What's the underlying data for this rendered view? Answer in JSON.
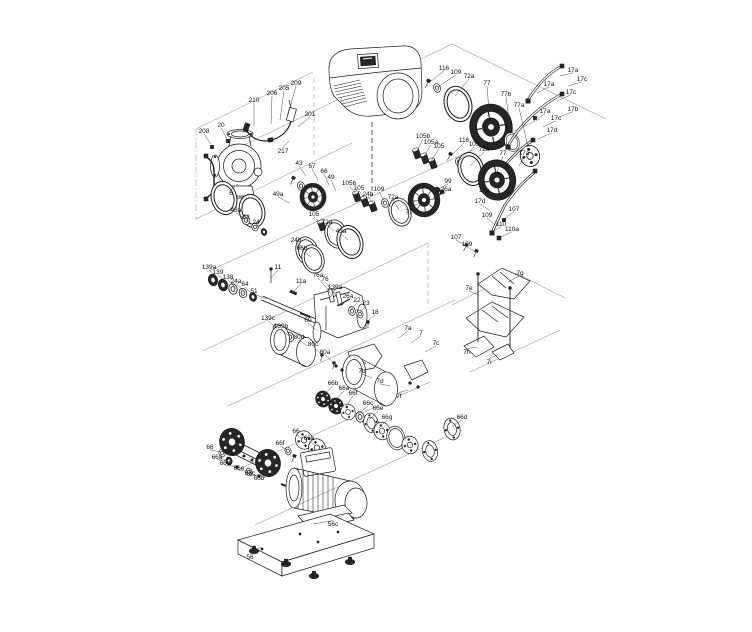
{
  "diagram": {
    "type": "exploded-parts-diagram",
    "colors": {
      "ink": "#1c1c1c",
      "lane": "#949494",
      "dark_fill": "#262626",
      "paper": "#ffffff"
    },
    "callouts": [
      {
        "t": "208",
        "x": 204,
        "y": 131,
        "tx": 211,
        "ty": 144
      },
      {
        "t": "20",
        "x": 221,
        "y": 125,
        "tx": 227,
        "ty": 139
      },
      {
        "t": "210",
        "x": 254,
        "y": 100,
        "tx": 254,
        "ty": 126
      },
      {
        "t": "206",
        "x": 272,
        "y": 93,
        "tx": 271,
        "ty": 124
      },
      {
        "t": "205",
        "x": 284,
        "y": 88,
        "tx": 280,
        "ty": 120
      },
      {
        "t": "209",
        "x": 296,
        "y": 83,
        "tx": 288,
        "ty": 115
      },
      {
        "t": "201",
        "x": 310,
        "y": 114,
        "tx": 298,
        "ty": 127
      },
      {
        "t": "217",
        "x": 283,
        "y": 151,
        "tx": 289,
        "ty": 141
      },
      {
        "t": "6",
        "x": 231,
        "y": 193,
        "tx": 238,
        "ty": 184
      },
      {
        "t": "116",
        "x": 444,
        "y": 68,
        "tx": 430,
        "ty": 82
      },
      {
        "t": "109",
        "x": 456,
        "y": 72,
        "tx": 438,
        "ty": 87
      },
      {
        "t": "72a",
        "x": 469,
        "y": 76,
        "tx": 455,
        "ty": 96
      },
      {
        "t": "77",
        "x": 487,
        "y": 83,
        "tx": 489,
        "ty": 112
      },
      {
        "t": "77b",
        "x": 506,
        "y": 94,
        "tx": 511,
        "ty": 135
      },
      {
        "t": "77a",
        "x": 519,
        "y": 105,
        "tx": 528,
        "ty": 147
      },
      {
        "t": "17a",
        "x": 573,
        "y": 70,
        "tx": 560,
        "ty": 76
      },
      {
        "t": "17c",
        "x": 582,
        "y": 79,
        "tx": 568,
        "ty": 86
      },
      {
        "t": "17a",
        "x": 549,
        "y": 84,
        "tx": 537,
        "ty": 93
      },
      {
        "t": "17c",
        "x": 571,
        "y": 92,
        "tx": 557,
        "ty": 101
      },
      {
        "t": "17b",
        "x": 573,
        "y": 109,
        "tx": 559,
        "ty": 117
      },
      {
        "t": "17a",
        "x": 545,
        "y": 111,
        "tx": 533,
        "ty": 121
      },
      {
        "t": "17c",
        "x": 556,
        "y": 118,
        "tx": 543,
        "ty": 127
      },
      {
        "t": "17d",
        "x": 552,
        "y": 130,
        "tx": 538,
        "ty": 139
      },
      {
        "t": "105b",
        "x": 423,
        "y": 136,
        "tx": 417,
        "ty": 151
      },
      {
        "t": "105a",
        "x": 431,
        "y": 142,
        "tx": 424,
        "ty": 156
      },
      {
        "t": "105",
        "x": 439,
        "y": 146,
        "tx": 431,
        "ty": 161
      },
      {
        "t": "116",
        "x": 464,
        "y": 140,
        "tx": 451,
        "ty": 156
      },
      {
        "t": "109",
        "x": 474,
        "y": 144,
        "tx": 459,
        "ty": 161
      },
      {
        "t": "72a",
        "x": 484,
        "y": 149,
        "tx": 470,
        "ty": 166
      },
      {
        "t": "77",
        "x": 503,
        "y": 153,
        "tx": 497,
        "ty": 172
      },
      {
        "t": "17a",
        "x": 524,
        "y": 153,
        "tx": 519,
        "ty": 166
      },
      {
        "t": "17c",
        "x": 484,
        "y": 190,
        "tx": 493,
        "ty": 199
      },
      {
        "t": "17d",
        "x": 480,
        "y": 201,
        "tx": 489,
        "ty": 210
      },
      {
        "t": "107",
        "x": 514,
        "y": 209,
        "tx": 504,
        "ty": 219
      },
      {
        "t": "109",
        "x": 487,
        "y": 215,
        "tx": 495,
        "ty": 225
      },
      {
        "t": "110",
        "x": 501,
        "y": 224,
        "tx": 491,
        "ty": 232
      },
      {
        "t": "110a",
        "x": 512,
        "y": 229,
        "tx": 499,
        "ty": 238
      },
      {
        "t": "107",
        "x": 456,
        "y": 237,
        "tx": 466,
        "ty": 246
      },
      {
        "t": "109",
        "x": 467,
        "y": 244,
        "tx": 476,
        "ty": 252
      },
      {
        "t": "105b",
        "x": 349,
        "y": 183,
        "tx": 357,
        "ty": 195
      },
      {
        "t": "105",
        "x": 359,
        "y": 188,
        "tx": 366,
        "ty": 200
      },
      {
        "t": "24b",
        "x": 368,
        "y": 194,
        "tx": 375,
        "ty": 206
      },
      {
        "t": "109",
        "x": 379,
        "y": 189,
        "tx": 385,
        "ty": 202
      },
      {
        "t": "72a",
        "x": 393,
        "y": 197,
        "tx": 399,
        "ty": 210
      },
      {
        "t": "99",
        "x": 448,
        "y": 181,
        "tx": 437,
        "ty": 190
      },
      {
        "t": "26a",
        "x": 446,
        "y": 189,
        "tx": 433,
        "ty": 198
      },
      {
        "t": "77",
        "x": 409,
        "y": 212,
        "tx": 417,
        "ty": 204
      },
      {
        "t": "43",
        "x": 299,
        "y": 163,
        "tx": 306,
        "ty": 176
      },
      {
        "t": "67",
        "x": 312,
        "y": 166,
        "tx": 318,
        "ty": 180
      },
      {
        "t": "66",
        "x": 324,
        "y": 171,
        "tx": 329,
        "ty": 185
      },
      {
        "t": "49",
        "x": 331,
        "y": 177,
        "tx": 336,
        "ty": 191
      },
      {
        "t": "49a",
        "x": 278,
        "y": 194,
        "tx": 289,
        "ty": 203
      },
      {
        "t": "105",
        "x": 314,
        "y": 214,
        "tx": 321,
        "ty": 224
      },
      {
        "t": "72a",
        "x": 327,
        "y": 222,
        "tx": 334,
        "ty": 231
      },
      {
        "t": "43a",
        "x": 236,
        "y": 210,
        "tx": 245,
        "ty": 219
      },
      {
        "t": "62",
        "x": 246,
        "y": 217,
        "tx": 254,
        "ty": 226
      },
      {
        "t": "24",
        "x": 256,
        "y": 222,
        "tx": 263,
        "ty": 231
      },
      {
        "t": "43a",
        "x": 341,
        "y": 231,
        "tx": 348,
        "ty": 240
      },
      {
        "t": "24b",
        "x": 296,
        "y": 240,
        "tx": 305,
        "ty": 249
      },
      {
        "t": "66b",
        "x": 302,
        "y": 248,
        "tx": 311,
        "ty": 257
      },
      {
        "t": "139a",
        "x": 209,
        "y": 267,
        "tx": 217,
        "ty": 277
      },
      {
        "t": "139",
        "x": 218,
        "y": 272,
        "tx": 226,
        "ty": 282
      },
      {
        "t": "138",
        "x": 228,
        "y": 277,
        "tx": 235,
        "ty": 287
      },
      {
        "t": "24a",
        "x": 236,
        "y": 281,
        "tx": 244,
        "ty": 291
      },
      {
        "t": "64",
        "x": 245,
        "y": 284,
        "tx": 252,
        "ty": 294
      },
      {
        "t": "51",
        "x": 254,
        "y": 291,
        "tx": 266,
        "ty": 299
      },
      {
        "t": "11",
        "x": 278,
        "y": 267,
        "tx": 271,
        "ty": 278
      },
      {
        "t": "11a",
        "x": 301,
        "y": 281,
        "tx": 293,
        "ty": 292
      },
      {
        "t": "76a",
        "x": 318,
        "y": 275,
        "tx": 330,
        "ty": 292
      },
      {
        "t": "76",
        "x": 325,
        "y": 279,
        "tx": 337,
        "ty": 297
      },
      {
        "t": "139a",
        "x": 335,
        "y": 287,
        "tx": 329,
        "ty": 299
      },
      {
        "t": "26a",
        "x": 348,
        "y": 296,
        "tx": 341,
        "ty": 306
      },
      {
        "t": "22",
        "x": 357,
        "y": 300,
        "tx": 351,
        "ty": 310
      },
      {
        "t": "23",
        "x": 366,
        "y": 303,
        "tx": 359,
        "ty": 313
      },
      {
        "t": "18",
        "x": 375,
        "y": 312,
        "tx": 368,
        "ty": 321
      },
      {
        "t": "60",
        "x": 308,
        "y": 320,
        "tx": 316,
        "ty": 330
      },
      {
        "t": "139c",
        "x": 268,
        "y": 318,
        "tx": 276,
        "ty": 328
      },
      {
        "t": "139b",
        "x": 281,
        "y": 326,
        "tx": 289,
        "ty": 336
      },
      {
        "t": "80d",
        "x": 299,
        "y": 337,
        "tx": 307,
        "ty": 346
      },
      {
        "t": "80c",
        "x": 313,
        "y": 344,
        "tx": 321,
        "ty": 354
      },
      {
        "t": "80a",
        "x": 325,
        "y": 352,
        "tx": 333,
        "ty": 362
      },
      {
        "t": "7a",
        "x": 408,
        "y": 328,
        "tx": 399,
        "ty": 338
      },
      {
        "t": "7",
        "x": 421,
        "y": 333,
        "tx": 411,
        "ty": 343
      },
      {
        "t": "7c",
        "x": 436,
        "y": 343,
        "tx": 425,
        "ty": 352
      },
      {
        "t": "7b",
        "x": 362,
        "y": 371,
        "tx": 372,
        "ty": 378
      },
      {
        "t": "7d",
        "x": 380,
        "y": 381,
        "tx": 390,
        "ty": 386
      },
      {
        "t": "7f",
        "x": 399,
        "y": 396,
        "tx": 408,
        "ty": 390
      },
      {
        "t": "7g",
        "x": 520,
        "y": 273,
        "tx": 508,
        "ty": 282
      },
      {
        "t": "7e",
        "x": 469,
        "y": 288,
        "tx": 479,
        "ty": 295
      },
      {
        "t": "7h",
        "x": 467,
        "y": 352,
        "tx": 477,
        "ty": 347
      },
      {
        "t": "7i",
        "x": 489,
        "y": 362,
        "tx": 497,
        "ty": 355
      },
      {
        "t": "66b",
        "x": 333,
        "y": 383,
        "tx": 323,
        "ty": 396
      },
      {
        "t": "66a",
        "x": 344,
        "y": 388,
        "tx": 334,
        "ty": 402
      },
      {
        "t": "66f",
        "x": 353,
        "y": 393,
        "tx": 345,
        "ty": 408
      },
      {
        "t": "66c",
        "x": 368,
        "y": 403,
        "tx": 358,
        "ty": 414
      },
      {
        "t": "66e",
        "x": 378,
        "y": 408,
        "tx": 369,
        "ty": 420
      },
      {
        "t": "66g",
        "x": 387,
        "y": 417,
        "tx": 379,
        "ty": 428
      },
      {
        "t": "66d",
        "x": 462,
        "y": 417,
        "tx": 452,
        "ty": 426
      },
      {
        "t": "66",
        "x": 210,
        "y": 447,
        "tx": 221,
        "ty": 452
      },
      {
        "t": "66a",
        "x": 217,
        "y": 457,
        "tx": 228,
        "ty": 460
      },
      {
        "t": "66d",
        "x": 225,
        "y": 463,
        "tx": 236,
        "ty": 466
      },
      {
        "t": "66e",
        "x": 239,
        "y": 468,
        "tx": 248,
        "ty": 471
      },
      {
        "t": "66c",
        "x": 250,
        "y": 473,
        "tx": 258,
        "ty": 475
      },
      {
        "t": "66b",
        "x": 259,
        "y": 478,
        "tx": 266,
        "ty": 478
      },
      {
        "t": "66",
        "x": 296,
        "y": 431,
        "tx": 303,
        "ty": 439
      },
      {
        "t": "66a",
        "x": 309,
        "y": 438,
        "tx": 316,
        "ty": 446
      },
      {
        "t": "66f",
        "x": 280,
        "y": 443,
        "tx": 287,
        "ty": 450
      },
      {
        "t": "56c",
        "x": 333,
        "y": 524,
        "tx": 313,
        "ty": 524
      },
      {
        "t": "56",
        "x": 250,
        "y": 557,
        "tx": 261,
        "ty": 547
      }
    ]
  }
}
